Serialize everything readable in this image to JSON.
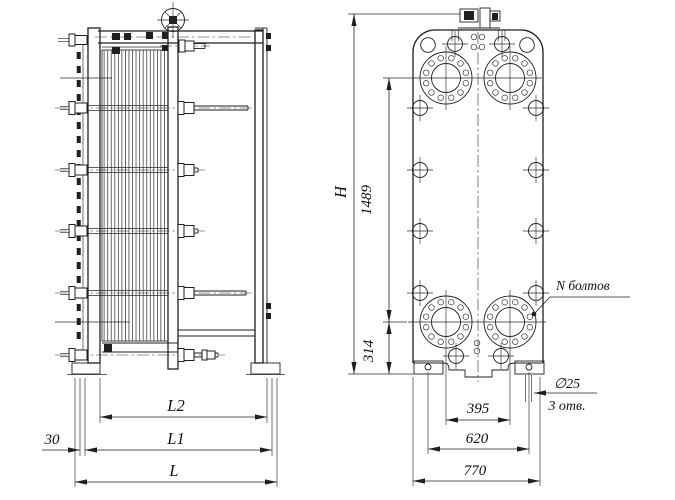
{
  "title": "Plate heat exchanger dimensional drawing",
  "colors": {
    "background": "#ffffff",
    "ink": "#1f1f1f"
  },
  "side_view": {
    "dims": {
      "offset_left": "30",
      "frame_span": "L2",
      "length_inner": "L1",
      "length_overall": "L"
    }
  },
  "front_view": {
    "dims": {
      "height_overall": "H",
      "port_span_vertical": "1489",
      "port_bottom_height": "314",
      "port_span_horizontal": "395",
      "feet_span": "620",
      "width_overall": "770"
    },
    "notes": {
      "bolts_note": "N болтов",
      "foot_hole_diameter": "∅25",
      "foot_hole_count": "3 отв."
    }
  }
}
